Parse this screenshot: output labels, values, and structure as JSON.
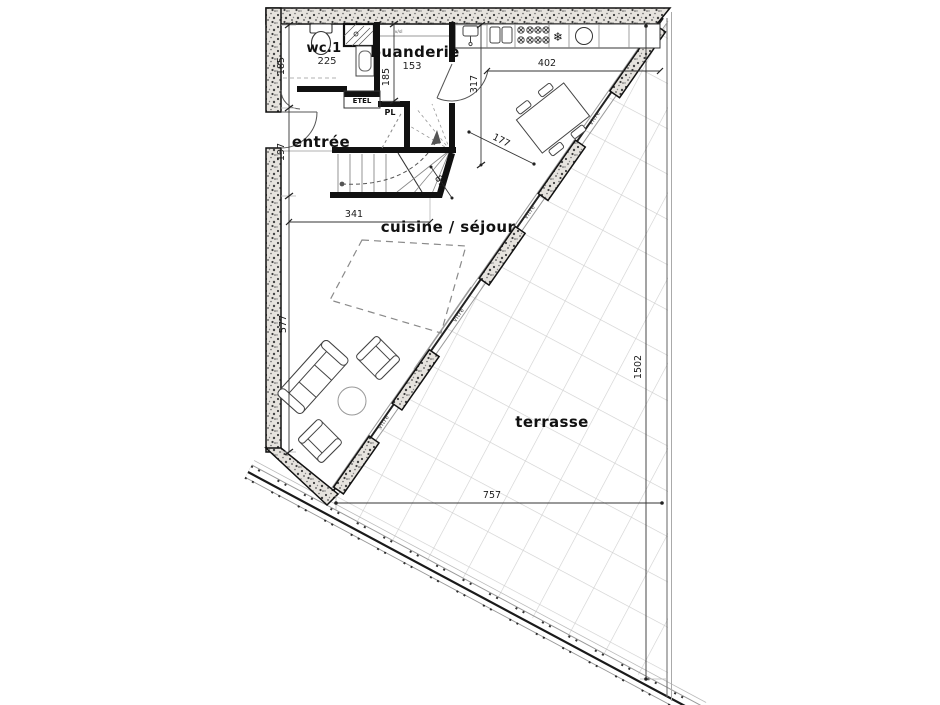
{
  "plan": {
    "rooms": {
      "wc": {
        "label": "wc.1",
        "area": "225"
      },
      "buanderie": {
        "label": "buanderie",
        "area": "153"
      },
      "entree": {
        "label": "entrée"
      },
      "sejour": {
        "label": "cuisine / séjour"
      },
      "terrasse": {
        "label": "terrasse"
      },
      "etel": {
        "label": "ETEL"
      },
      "pl": {
        "label": "PL"
      }
    },
    "dims": {
      "left_upper": "185",
      "left_door": "197",
      "left_lower": "577",
      "buanderie_height": "185",
      "kitchen_depth": "317",
      "kitchen_width": "402",
      "sejour_width": "341",
      "stair_corner": "89",
      "table_clearance": "177",
      "terrasse_width": "757",
      "terrasse_height": "1502"
    },
    "notes": {
      "glazing": "vitre",
      "counter_note": "lv/sl"
    },
    "icons": {
      "fridge": "❄"
    },
    "colors": {
      "line": "#1d1d1b",
      "wall_fill": "#e6e3de",
      "tile_line": "#cfcfcf",
      "dim_text": "#1a1a1a"
    }
  }
}
